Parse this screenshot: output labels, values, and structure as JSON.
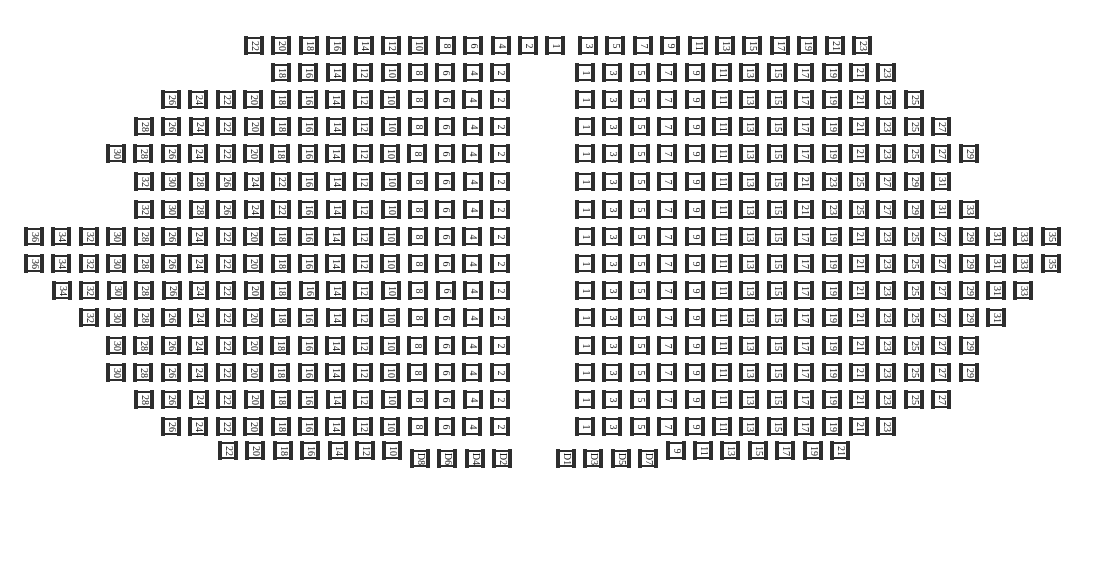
{
  "seat_map": {
    "colors": {
      "seat_border": "#2e2e2e",
      "seat_text": "#1c1c1c",
      "background": "#ffffff"
    },
    "layout": {
      "pitch_x": 27.4,
      "seat_outer_w": 20,
      "seat_outer_h": 19,
      "d_seat_y_offset": 8
    },
    "rows": [
      {
        "y": 36,
        "blocks": [
          {
            "x": 244,
            "seats": [
              "22",
              "20",
              "18",
              "16",
              "14",
              "12",
              "10",
              "8",
              "6",
              "4",
              "2",
              "1"
            ]
          },
          {
            "x": 578,
            "seats": [
              "3",
              "5",
              "7",
              "9",
              "11",
              "13",
              "15",
              "17",
              "19",
              "21",
              "23"
            ]
          }
        ]
      },
      {
        "y": 63,
        "blocks": [
          {
            "x": 271,
            "seats": [
              "18",
              "16",
              "14",
              "12",
              "10",
              "8",
              "6",
              "4",
              "2"
            ]
          },
          {
            "x": 575,
            "seats": [
              "1",
              "3",
              "5",
              "7",
              "9",
              "11",
              "13",
              "15",
              "17",
              "19",
              "21",
              "23"
            ]
          }
        ]
      },
      {
        "y": 90,
        "blocks": [
          {
            "x": 161,
            "seats": [
              "26",
              "24",
              "22",
              "20",
              "18",
              "16",
              "14",
              "12",
              "10",
              "8",
              "6",
              "4",
              "2"
            ]
          },
          {
            "x": 575,
            "seats": [
              "1",
              "3",
              "5",
              "7",
              "9",
              "11",
              "13",
              "15",
              "17",
              "19",
              "21",
              "23",
              "25"
            ]
          }
        ]
      },
      {
        "y": 117,
        "blocks": [
          {
            "x": 134,
            "seats": [
              "28",
              "26",
              "24",
              "22",
              "20",
              "18",
              "16",
              "14",
              "12",
              "10",
              "8",
              "6",
              "4",
              "2"
            ]
          },
          {
            "x": 575,
            "seats": [
              "1",
              "3",
              "5",
              "7",
              "9",
              "11",
              "13",
              "15",
              "17",
              "19",
              "21",
              "23",
              "25",
              "27"
            ]
          }
        ]
      },
      {
        "y": 144,
        "blocks": [
          {
            "x": 106,
            "seats": [
              "30",
              "28",
              "26",
              "24",
              "22",
              "20",
              "18",
              "16",
              "14",
              "12",
              "10",
              "8",
              "6",
              "4",
              "2"
            ]
          },
          {
            "x": 575,
            "seats": [
              "1",
              "3",
              "5",
              "7",
              "9",
              "11",
              "13",
              "15",
              "17",
              "19",
              "21",
              "23",
              "25",
              "27",
              "29"
            ]
          }
        ]
      },
      {
        "y": 172,
        "blocks": [
          {
            "x": 134,
            "seats": [
              "32",
              "30",
              "28",
              "26",
              "24",
              "22",
              "16",
              "14",
              "12",
              "10",
              "8",
              "6",
              "4",
              "2"
            ]
          },
          {
            "x": 575,
            "seats": [
              "1",
              "3",
              "5",
              "7",
              "9",
              "11",
              "13",
              "15",
              "21",
              "23",
              "25",
              "27",
              "29",
              "31"
            ]
          }
        ]
      },
      {
        "y": 200,
        "blocks": [
          {
            "x": 134,
            "seats": [
              "32",
              "30",
              "28",
              "26",
              "24",
              "22",
              "16",
              "14",
              "12",
              "10",
              "8",
              "6",
              "4",
              "2"
            ]
          },
          {
            "x": 575,
            "seats": [
              "1",
              "3",
              "5",
              "7",
              "9",
              "11",
              "13",
              "15",
              "21",
              "23",
              "25",
              "27",
              "29",
              "31",
              "33"
            ]
          }
        ]
      },
      {
        "y": 227,
        "blocks": [
          {
            "x": 24,
            "seats": [
              "36",
              "34",
              "32",
              "30",
              "28",
              "26",
              "24",
              "22",
              "20",
              "18",
              "16",
              "14",
              "12",
              "10",
              "8",
              "6",
              "4",
              "2"
            ]
          },
          {
            "x": 575,
            "seats": [
              "1",
              "3",
              "5",
              "7",
              "9",
              "11",
              "13",
              "15",
              "17",
              "19",
              "21",
              "23",
              "25",
              "27",
              "29",
              "31",
              "33",
              "35"
            ]
          }
        ]
      },
      {
        "y": 254,
        "blocks": [
          {
            "x": 24,
            "seats": [
              "36",
              "34",
              "32",
              "30",
              "28",
              "26",
              "24",
              "22",
              "20",
              "18",
              "16",
              "14",
              "12",
              "10",
              "8",
              "6",
              "4",
              "2"
            ]
          },
          {
            "x": 575,
            "seats": [
              "1",
              "3",
              "5",
              "7",
              "9",
              "11",
              "13",
              "15",
              "17",
              "19",
              "21",
              "23",
              "25",
              "27",
              "29",
              "31",
              "33",
              "35"
            ]
          }
        ]
      },
      {
        "y": 281,
        "blocks": [
          {
            "x": 52,
            "seats": [
              "34",
              "32",
              "30",
              "28",
              "26",
              "24",
              "22",
              "20",
              "18",
              "16",
              "14",
              "12",
              "10",
              "8",
              "6",
              "4",
              "2"
            ]
          },
          {
            "x": 575,
            "seats": [
              "1",
              "3",
              "5",
              "7",
              "9",
              "11",
              "13",
              "15",
              "17",
              "19",
              "21",
              "23",
              "25",
              "27",
              "29",
              "31",
              "33"
            ]
          }
        ]
      },
      {
        "y": 308,
        "blocks": [
          {
            "x": 79,
            "seats": [
              "32",
              "30",
              "28",
              "26",
              "24",
              "22",
              "20",
              "18",
              "16",
              "14",
              "12",
              "10",
              "8",
              "6",
              "4",
              "2"
            ]
          },
          {
            "x": 575,
            "seats": [
              "1",
              "3",
              "5",
              "7",
              "9",
              "11",
              "13",
              "15",
              "17",
              "19",
              "21",
              "23",
              "25",
              "27",
              "29",
              "31"
            ]
          }
        ]
      },
      {
        "y": 336,
        "blocks": [
          {
            "x": 106,
            "seats": [
              "30",
              "28",
              "26",
              "24",
              "22",
              "20",
              "18",
              "16",
              "14",
              "12",
              "10",
              "8",
              "6",
              "4",
              "2"
            ]
          },
          {
            "x": 575,
            "seats": [
              "1",
              "3",
              "5",
              "7",
              "9",
              "11",
              "13",
              "15",
              "17",
              "19",
              "21",
              "23",
              "25",
              "27",
              "29"
            ]
          }
        ]
      },
      {
        "y": 363,
        "blocks": [
          {
            "x": 106,
            "seats": [
              "30",
              "28",
              "26",
              "24",
              "22",
              "20",
              "18",
              "16",
              "14",
              "12",
              "10",
              "8",
              "6",
              "4",
              "2"
            ]
          },
          {
            "x": 575,
            "seats": [
              "1",
              "3",
              "5",
              "7",
              "9",
              "11",
              "13",
              "15",
              "17",
              "19",
              "21",
              "23",
              "25",
              "27",
              "29"
            ]
          }
        ]
      },
      {
        "y": 390,
        "blocks": [
          {
            "x": 134,
            "seats": [
              "28",
              "26",
              "24",
              "22",
              "20",
              "18",
              "16",
              "14",
              "12",
              "10",
              "8",
              "6",
              "4",
              "2"
            ]
          },
          {
            "x": 575,
            "seats": [
              "1",
              "3",
              "5",
              "7",
              "9",
              "11",
              "13",
              "15",
              "17",
              "19",
              "21",
              "23",
              "25",
              "27"
            ]
          }
        ]
      },
      {
        "y": 417,
        "blocks": [
          {
            "x": 161,
            "seats": [
              "26",
              "24",
              "22",
              "20",
              "18",
              "16",
              "14",
              "12",
              "10",
              "8",
              "6",
              "4",
              "2"
            ]
          },
          {
            "x": 575,
            "seats": [
              "1",
              "3",
              "5",
              "7",
              "9",
              "11",
              "13",
              "15",
              "17",
              "19",
              "21",
              "23"
            ]
          }
        ]
      },
      {
        "y": 441,
        "blocks": [
          {
            "x": 218,
            "seats": [
              "22",
              "20",
              "18",
              "16",
              "14",
              "12",
              "10",
              "D8",
              "D6",
              "D4",
              "D2"
            ]
          },
          {
            "x": 556,
            "seats": [
              "D1",
              "D3",
              "D5",
              "D7",
              "9",
              "11",
              "13",
              "15",
              "17",
              "19",
              "21"
            ]
          }
        ]
      }
    ]
  }
}
